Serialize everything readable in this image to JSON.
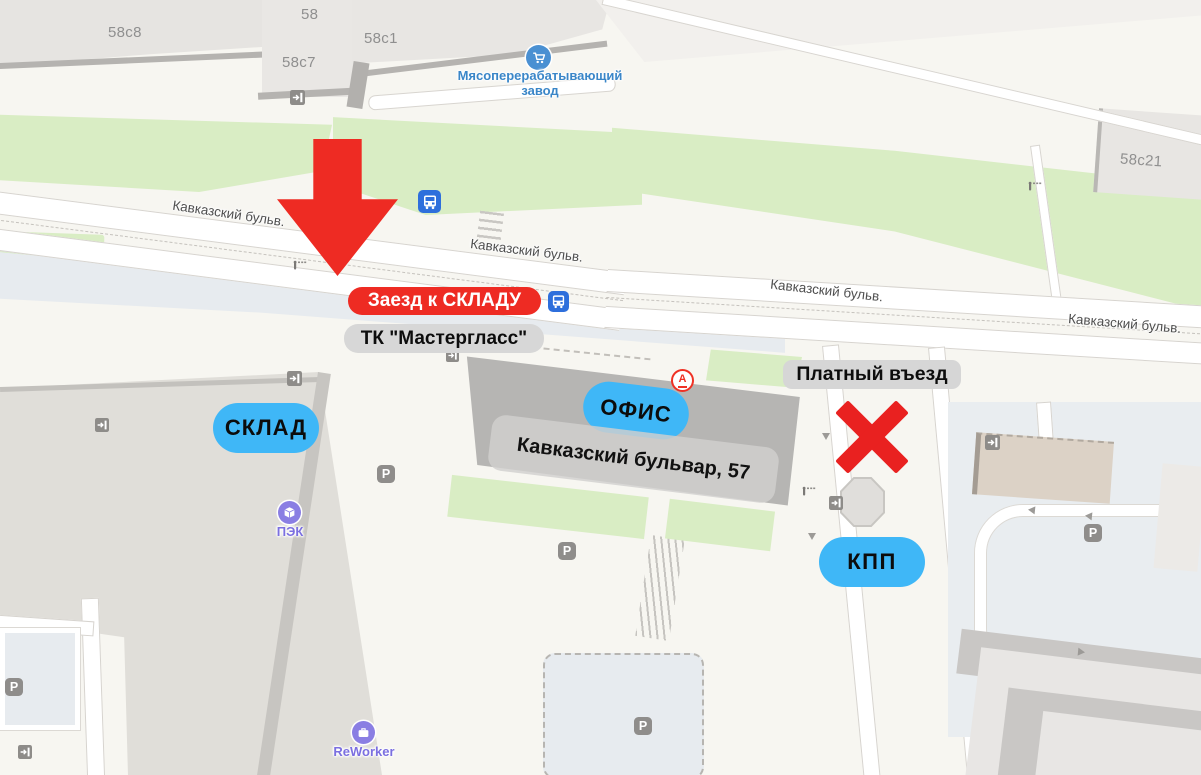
{
  "map": {
    "streets": {
      "kavkazsky_abbr": "Кавказский бульв."
    },
    "buildings": {
      "b58c8": "58с8",
      "b58": "58",
      "b58c7": "58с7",
      "b58c1": "58с1",
      "b58c21": "58с21"
    },
    "pois": {
      "meat_plant": {
        "line1": "Мясоперерабатывающий",
        "line2": "завод"
      },
      "pek": "ПЭК",
      "reworker": "ReWorker",
      "alfabank_letter": "А"
    },
    "markers": {
      "parking_letter": "P"
    },
    "annotations": {
      "entry_to_warehouse": "Заезд к СКЛАДУ",
      "mall_name": "ТК \"Мастергласс\"",
      "warehouse": "СКЛАД",
      "office": "ОФИС",
      "address": "Кавказский бульвар, 57",
      "paid_entry": "Платный въезд",
      "checkpoint": "КПП"
    },
    "icon_names": {
      "transit": "bus-stop-icon",
      "shop": "shopping-cart-icon",
      "box": "package-icon",
      "briefcase": "briefcase-icon",
      "bank": "alfabank-icon",
      "parking": "parking-icon",
      "entrance": "entrance-icon",
      "gate": "barrier-gate-icon"
    },
    "colors": {
      "annotation_red": "#ee2b23",
      "annotation_blue": "#3fb7f7",
      "annotation_gray": "#d7d7d7",
      "poi_purple": "#8a7ee3",
      "poi_blue_text": "#3a86c8",
      "transit_blue": "#2e6fdc",
      "green_area": "#d9edc4",
      "parking_area": "#e7ebef"
    }
  }
}
